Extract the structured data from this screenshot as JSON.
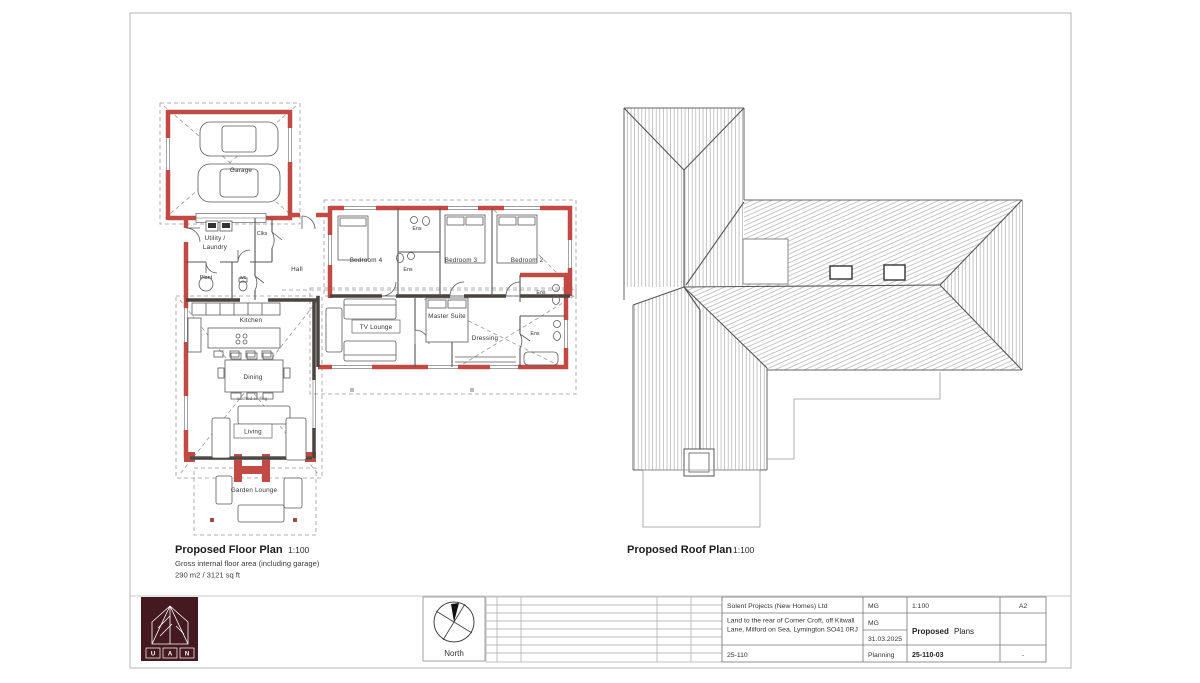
{
  "floor_plan": {
    "title": "Proposed Floor Plan",
    "scale": "1:100",
    "subtitle": "Gross internal floor area (including garage)",
    "area": "290 m2 / 3121 sq ft",
    "rooms": {
      "garage": "Garage",
      "utility1": "Utility /",
      "utility2": "Laundry",
      "clks": "Clks",
      "hall": "Hall",
      "plant": "Plant",
      "wc": "wc",
      "bedroom4": "Bedroom 4",
      "ens_top": "Ens",
      "ens_mid": "Ens",
      "bedroom3": "Bedroom 3",
      "bedroom2": "Bedroom 2",
      "ens_b2": "Ens",
      "master": "Master Suite",
      "tv_lounge": "TV Lounge",
      "dressing": "Dressing",
      "ens_master": "Ens",
      "kitchen": "Kitchen",
      "dining": "Dining",
      "vaulted": "vaulted ceiling",
      "living": "Living",
      "garden_lounge": "Garden Lounge"
    }
  },
  "roof_plan": {
    "title": "Proposed Roof Plan",
    "scale": "1:100"
  },
  "north": {
    "label": "North"
  },
  "logo": {
    "letters": [
      "U",
      "A",
      "N"
    ]
  },
  "title_block": {
    "company": "Solent Projects (New Homes) Ltd",
    "address_line1": "Land to the rear of Corner Croft, off Kitwall",
    "address_line2": "Lane, Milford on Sea, Lymington SO41 0RJ",
    "job_number": "25-110",
    "drawn": "MG",
    "checked": "MG",
    "date": "31.03.2025",
    "status": "Planning",
    "scale": "1:100",
    "paper_size": "A2",
    "drawing_title_bold": "Proposed",
    "drawing_title_rest": "Plans",
    "drawing_number": "25-110-03",
    "revision": "-"
  },
  "colors": {
    "wall_red": "#c14b44",
    "wall_dark": "#4a4440",
    "logo_maroon": "#44191f",
    "line": "#555555"
  }
}
